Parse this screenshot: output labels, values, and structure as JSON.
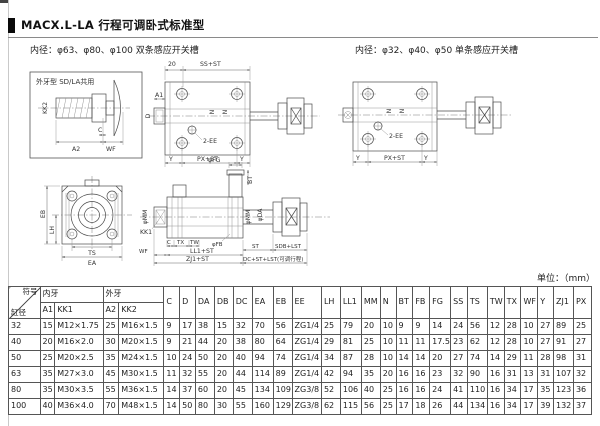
{
  "page": {
    "title": "MACX.L-LA 行程可调卧式标准型",
    "subtitle_left": "内径：φ63、φ80、φ100 双条感应开关槽",
    "subtitle_right": "内径：φ32、φ40、φ50 单条感应开关槽",
    "unit_label": "单位：（mm）"
  },
  "drawings": {
    "inset": {
      "title": "外牙型 SD/LA共用",
      "kk2": "KK2",
      "a2": "A2",
      "c": "C",
      "wf": "WF"
    },
    "cyl_large": {
      "d20": "20",
      "ss": "SS+ST",
      "a1": "A1",
      "d": "D",
      "n1": "N",
      "n2": "N",
      "ee": "2-EE",
      "y1": "Y",
      "px": "PX+ST",
      "y2": "Y"
    },
    "cyl_small": {
      "n1": "N",
      "n2": "N",
      "ee": "2-EE",
      "y1": "Y",
      "px": "PX+ST",
      "y2": "Y"
    },
    "end_view": {
      "eb": "EB",
      "lh": "LH",
      "ts": "TS",
      "ea": "EA"
    },
    "side_view": {
      "fg": "φFG",
      "bt": "BT",
      "mm": "φMM",
      "kk1": "KK1",
      "c": "C",
      "tx": "TX",
      "tw": "TW",
      "fb": "φFB",
      "wf": "WF",
      "ll1": "LL1+ST",
      "mm2": "φMM",
      "da": "φDA",
      "st": "ST",
      "sdb": "SDB+LST",
      "zj1": "ZJ1+ST",
      "dc": "DC+ST+LST(可调行程)"
    }
  },
  "table": {
    "corner": {
      "top": "符号",
      "bottom": "缸径"
    },
    "group_headers": [
      {
        "label": "内牙"
      },
      {
        "label": "外牙"
      }
    ],
    "sub_headers": [
      "A1",
      "KK1",
      "A2",
      "KK2"
    ],
    "columns": [
      "C",
      "D",
      "DA",
      "DB",
      "DC",
      "EA",
      "EB",
      "EE",
      "LH",
      "LL1",
      "MM",
      "N",
      "BT",
      "FB",
      "FG",
      "SS",
      "TS",
      "TW",
      "TX",
      "WF",
      "Y",
      "ZJ1",
      "PX"
    ],
    "rows": [
      [
        "32",
        "15",
        "M12×1.75",
        "25",
        "M16×1.5",
        "9",
        "17",
        "38",
        "15",
        "32",
        "70",
        "56",
        "ZG1/4",
        "25",
        "79",
        "20",
        "10",
        "9",
        "9",
        "14",
        "24",
        "56",
        "12",
        "28",
        "10",
        "27",
        "89",
        "25"
      ],
      [
        "40",
        "20",
        "M16×2.0",
        "30",
        "M20×1.5",
        "9",
        "21",
        "44",
        "20",
        "38",
        "80",
        "64",
        "ZG1/4",
        "29",
        "81",
        "25",
        "10",
        "11",
        "11",
        "17.5",
        "23",
        "62",
        "12",
        "28",
        "10",
        "27",
        "91",
        "27"
      ],
      [
        "50",
        "25",
        "M20×2.5",
        "35",
        "M24×1.5",
        "10",
        "24",
        "50",
        "20",
        "40",
        "94",
        "74",
        "ZG1/4",
        "34",
        "87",
        "28",
        "10",
        "14",
        "14",
        "20",
        "27",
        "74",
        "14",
        "29",
        "11",
        "28",
        "98",
        "31"
      ],
      [
        "63",
        "35",
        "M27×3.0",
        "45",
        "M30×1.5",
        "11",
        "32",
        "55",
        "20",
        "44",
        "114",
        "89",
        "ZG1/4",
        "42",
        "94",
        "35",
        "20",
        "16",
        "16",
        "23",
        "32",
        "90",
        "16",
        "31",
        "13",
        "31",
        "107",
        "32"
      ],
      [
        "80",
        "35",
        "M30×3.5",
        "55",
        "M36×1.5",
        "14",
        "37",
        "60",
        "20",
        "45",
        "134",
        "109",
        "ZG3/8",
        "52",
        "106",
        "40",
        "25",
        "16",
        "16",
        "24",
        "41",
        "110",
        "16",
        "34",
        "17",
        "35",
        "123",
        "36"
      ],
      [
        "100",
        "40",
        "M36×4.0",
        "70",
        "M48×1.5",
        "14",
        "50",
        "80",
        "30",
        "55",
        "160",
        "129",
        "ZG3/8",
        "62",
        "115",
        "56",
        "25",
        "17",
        "18",
        "26",
        "44",
        "134",
        "16",
        "34",
        "17",
        "39",
        "132",
        "37"
      ]
    ]
  }
}
